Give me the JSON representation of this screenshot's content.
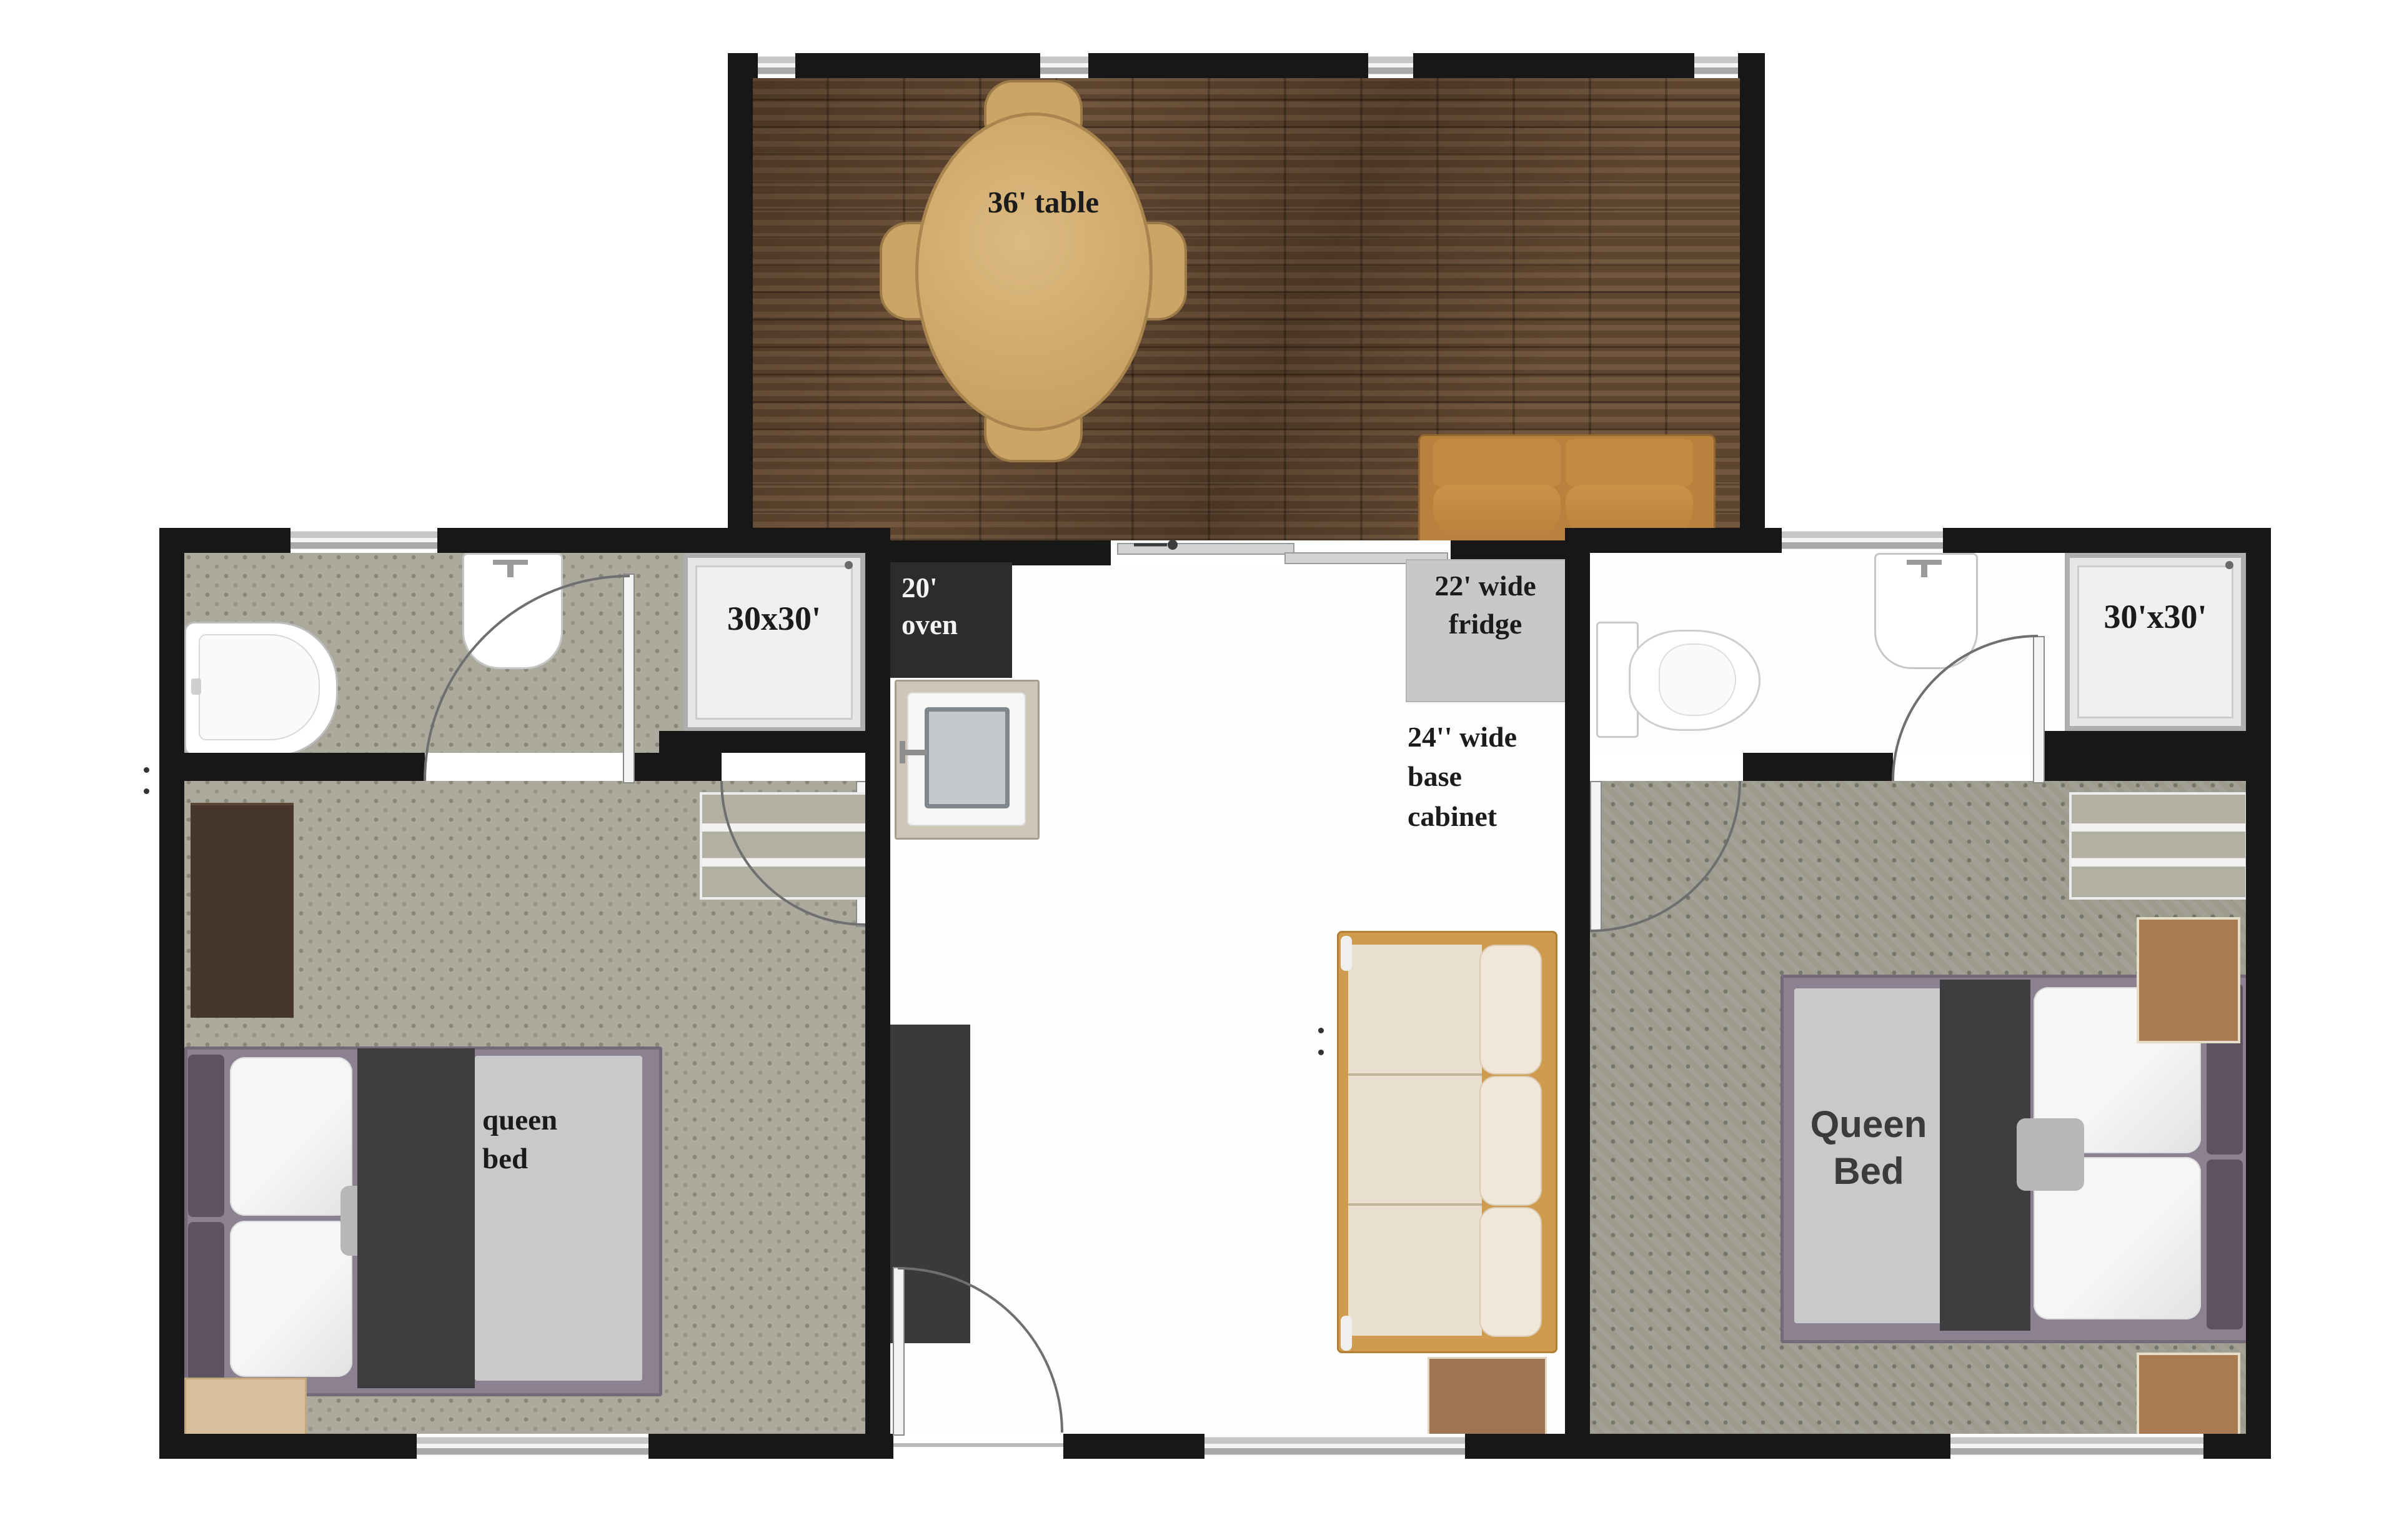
{
  "labels": {
    "dining_table": "36' table",
    "left_shower": "30x30'",
    "right_shower": "30'x30'",
    "oven": "20'\noven",
    "fridge": "22' wide\nfridge",
    "base_cabinet": "24'' wide\nbase\ncabinet",
    "left_bed": "queen\nbed",
    "right_bed": "Queen\nBed"
  },
  "colors": {
    "wall": "#171717",
    "wood_floor": "#6b4e35",
    "tile_floor": "#abaa9c",
    "tile_floor_dark": "#9c9b8e",
    "furniture_tan": "#c9a061",
    "loveseat_ochre": "#b8813e",
    "sofa_frame": "#cf9b4e",
    "sofa_cushion": "#e9dfcf",
    "oven": "#2c2c2e",
    "fridge": "#c8c8c8",
    "counter": "#3a3a3c",
    "bed_frame": "#8b8190",
    "blanket": "#3d3d3f",
    "label_text": "#1b1b1b"
  }
}
